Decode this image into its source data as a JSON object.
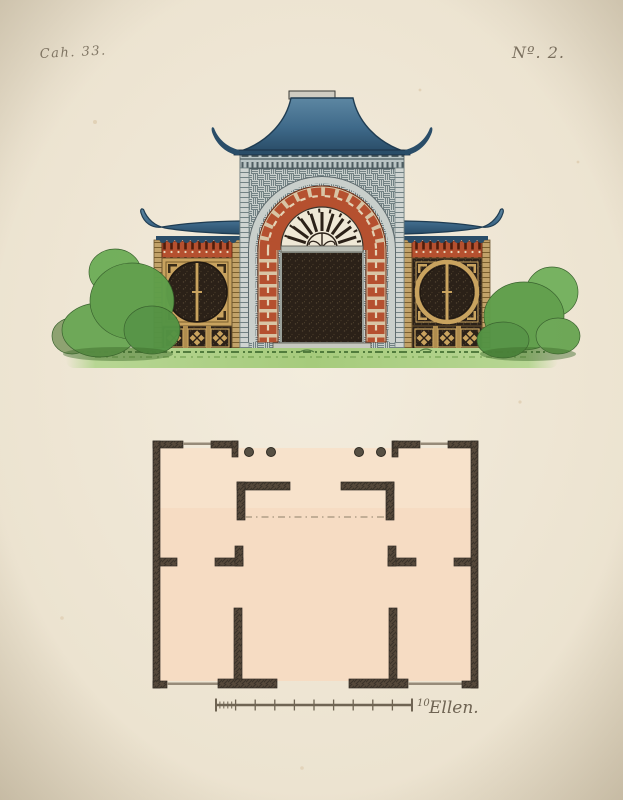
{
  "plate": {
    "series_label": "Cah. 33.",
    "number_label": "Nº. 2.",
    "scale_value": "10",
    "scale_unit": "Ellen."
  },
  "colors": {
    "paper": "#efe8d7",
    "paper-edge": "#d9cfba",
    "ink": "#6f6453",
    "roof-blue": "#3f6a8a",
    "roof-blue-dark": "#2a4d68",
    "masonry": "#c6cdca",
    "masonry-line": "#728284",
    "red": "#b5502f",
    "red-dark": "#7c2c12",
    "gold": "#c9a35f",
    "opening-dark": "#2b2118",
    "bush-green": "#5f9e4a",
    "grass-green": "#a6cb7c",
    "plan-floor": "#f6dcc3",
    "plan-wall": "#56493b"
  }
}
